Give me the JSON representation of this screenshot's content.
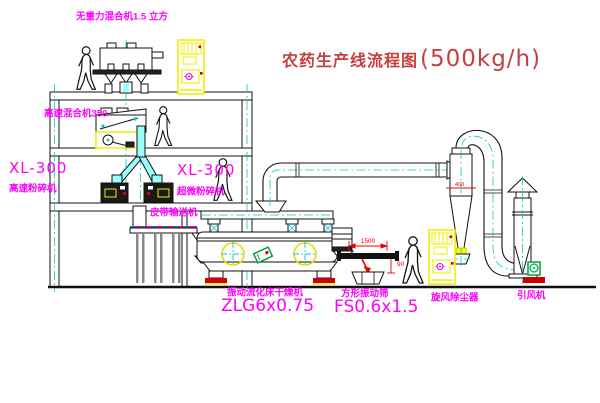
{
  "title": {
    "text": "农药生产线流程图",
    "capacity": "(500kg/h)"
  },
  "labels": {
    "gravity_free_mixer": "无重力混合机1.5 立方",
    "high_speed_mixer": "高速混合机350",
    "left_mill_model": "XL-300",
    "left_mill_name": "高速粉碎机",
    "mid_mill_model": "XL-300",
    "mid_mill_name": "超微粉碎机",
    "belt_conveyor": "皮带输送机",
    "dryer_name": "振动流化床干燥机",
    "dryer_model": "ZLG6x0.75",
    "screen_name": "方形振动筛",
    "screen_model": "FS0.6x1.5",
    "cyclone": "旋风除尘器",
    "induced_draft_fan": "引风机"
  },
  "dimensions": {
    "screen_length": "1500",
    "screen_drop": "90",
    "cyclone_dia": "400"
  },
  "colors": {
    "label_magenta": "#ff00ff",
    "title_red": "#c54040",
    "dimension_red": "#ee0000",
    "equipment_yellow": "#f0f000",
    "centerline_cyan": "#00cccc",
    "machine_green": "#00a040",
    "base_red": "#cc0000"
  }
}
